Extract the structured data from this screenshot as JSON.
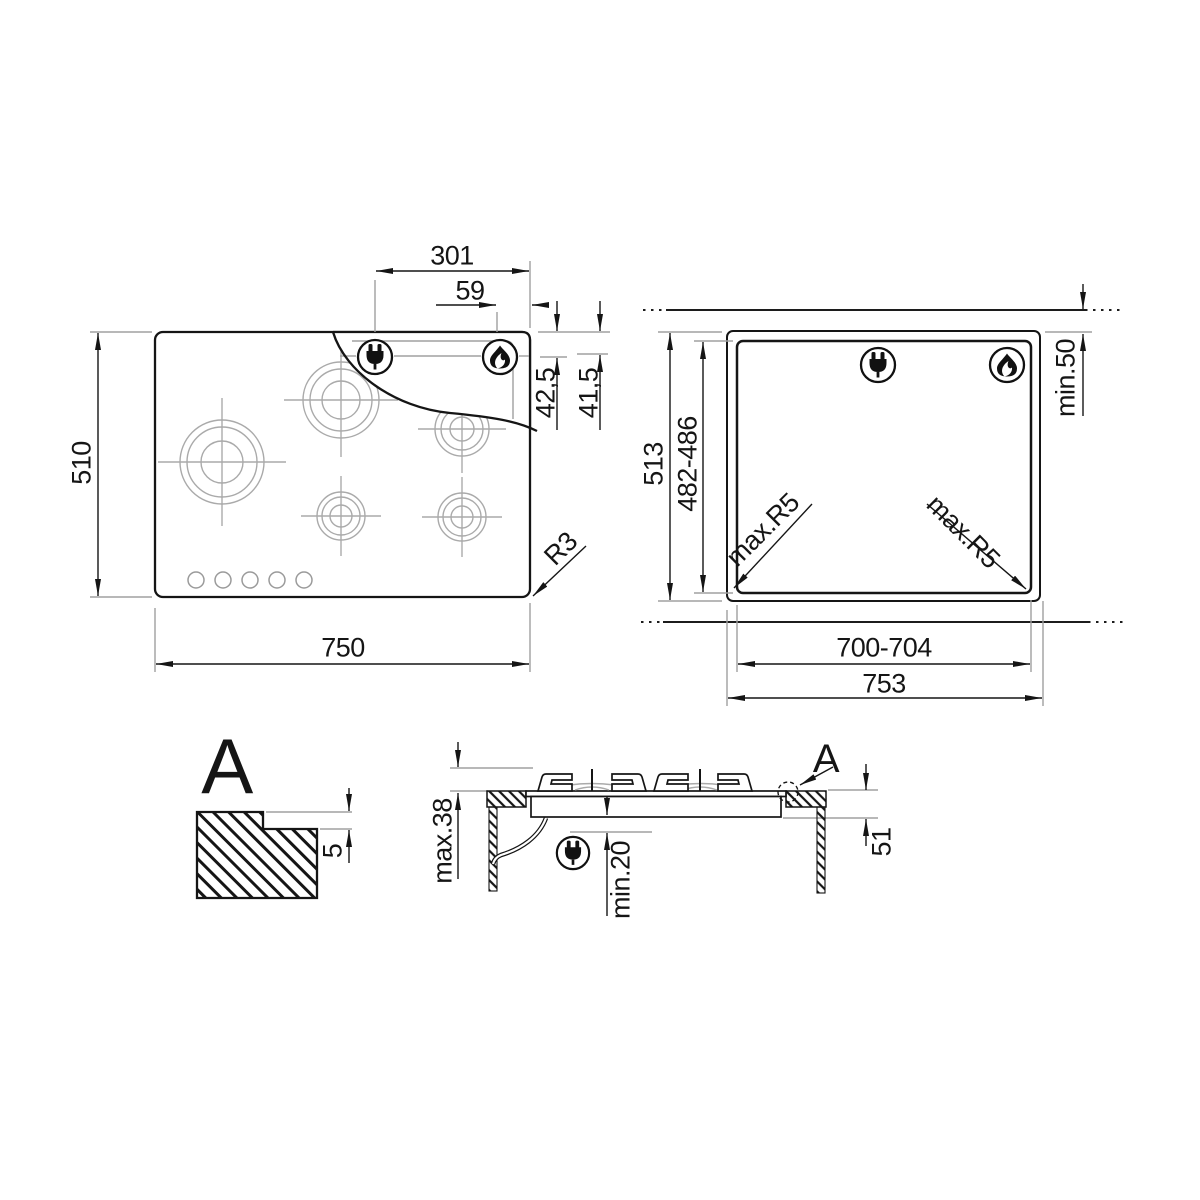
{
  "dims": {
    "top_view": {
      "height": "510",
      "width": "750",
      "plug_offset": "301",
      "flame_offset": "59",
      "plug_inset": "42,5",
      "flame_inset": "41,5",
      "corner_radius": "R3"
    },
    "cutout_view": {
      "panel_height": "513",
      "cutout_height": "482-486",
      "rear_clearance": "min.50",
      "cutout_width": "700-704",
      "panel_width": "753",
      "corner_radius_left": "max.R5",
      "corner_radius_right": "max.R5"
    },
    "detail_a": {
      "label": "A",
      "step_depth": "5"
    },
    "side_view": {
      "detail_label": "A",
      "height_above_worktop": "max.38",
      "clearance_below": "min.20",
      "depth_below_worktop": "51"
    }
  },
  "icons": {
    "plug": "power-plug-icon",
    "flame": "gas-flame-icon"
  },
  "colors": {
    "line": "#151515",
    "light_line": "#a0a0a0",
    "background": "#ffffff"
  }
}
